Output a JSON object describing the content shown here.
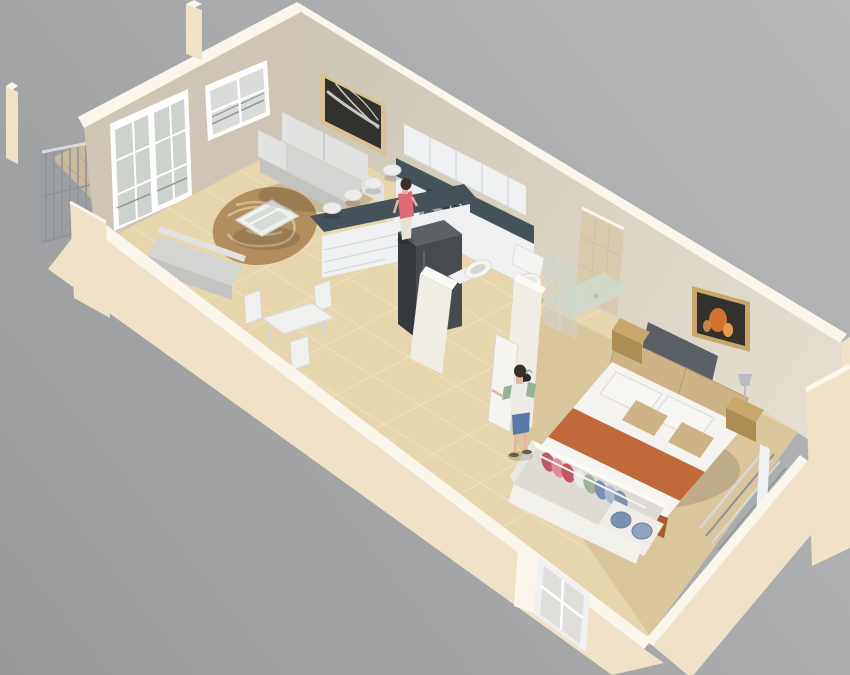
{
  "scene": {
    "type": "3d-floor-plan-render",
    "description": "Isometric 3D rendering of a studio apartment floor plan viewed from above",
    "rooms": [
      {
        "name": "balcony",
        "objects": [
          "corner-posts",
          "metal-railing",
          "plank-floor"
        ]
      },
      {
        "name": "living-room",
        "objects": [
          "sofa",
          "wall-art",
          "round-rug",
          "coffee-table",
          "bench",
          "dining-table",
          "dining-chairs",
          "bar-stools"
        ]
      },
      {
        "name": "kitchen",
        "objects": [
          "upper-cabinets",
          "dark-countertop",
          "cooktop",
          "oven",
          "refrigerator",
          "base-cabinet-drawers",
          "breakfast-bar"
        ]
      },
      {
        "name": "bathroom",
        "objects": [
          "toilet",
          "sink",
          "shower-glass-partition",
          "tiled-shower-wall",
          "floor-plant"
        ]
      },
      {
        "name": "bedroom",
        "objects": [
          "double-bed",
          "orange-runner",
          "white-pillows",
          "tan-pillows",
          "headboard",
          "nightstand-left",
          "nightstand-right",
          "table-lamp",
          "fire-wall-art",
          "open-wardrobe",
          "hanging-clothes",
          "folded-clothes",
          "window-railing",
          "corner-window"
        ]
      }
    ],
    "people": [
      {
        "name": "woman-at-kitchen-counter",
        "top_color": "#e06a78"
      },
      {
        "name": "man-near-wardrobe",
        "shorts_color": "#5b79a8"
      }
    ]
  },
  "colors": {
    "bg_top": "#b7b9bb",
    "bg_bottom": "#96989a",
    "wall_top": "#faf6ec",
    "wall_cream": "#f0e2c6",
    "wall_cream_dark": "#e2cda8",
    "wall_end_light": "#efe8d8",
    "wall_int_nw": "#cec5b4",
    "wall_int_ne_dark": "#cfc7b6",
    "wall_int_ne_light": "#e5dfd2",
    "partition_white": "#f0ede5",
    "partition_top": "#fbfaf5",
    "floor_tile": "#e6d5ad",
    "floor_grout": "#f4ead0",
    "floor_bedroom": "#dac69c",
    "carpet_edge": "#cdb88c",
    "balcony_floor": "#d8c49c",
    "plank_line": "#c5ad82",
    "rug": "#b28e5e",
    "rug_swirl": "#d9c09a",
    "glass": "#ccd6cf",
    "table_white": "#f0f1ee",
    "sofa_light": "#e2e2e0",
    "sofa_mid": "#d4d4d2",
    "sofa_dark": "#c3c3c1",
    "counter_dark": "#46525a",
    "counter_darker": "#333d44",
    "cabinet_white": "#eef0f1",
    "cabinet_line": "#d4d7d9",
    "steel": "#9aa0a4",
    "steel_dark": "#4a4e52",
    "fridge_top": "#5c6164",
    "fridge_left": "#35393c",
    "fridge_front": "#474b4e",
    "metal": "#8e9397",
    "rail_light": "#d7d9da",
    "rail_shade": "#8f9294",
    "wood": "#c8a76d",
    "wood_dark": "#ad8c55",
    "wood_floor_edge": "#d9c9a8",
    "bed_white": "#f5f3ef",
    "sheet_white": "#f7f5f1",
    "bed_orange": "#c06a3c",
    "bed_orange_dark": "#aa5a30",
    "bed_tan": "#cdb386",
    "pillow_white": "#f8f6f2",
    "pillow_line": "#e2dfd8",
    "headboard_gray": "#5b6067",
    "toilet_white": "#f4f4f2",
    "porcelain_shadow": "#d8d9d5",
    "tile_shower": "#d9ccae",
    "tile_line": "#c9bc9e",
    "clothes_red": "#c25663",
    "clothes_pink": "#de8f96",
    "clothes_blue": "#7b90b2",
    "clothes_blue2": "#8fa3bf",
    "clothes_lightblue": "#a8b8d0",
    "clothes_green": "#9db39a",
    "clothes_white": "#e9e9e7",
    "wardrobe_rim": "#fafaf7",
    "wardrobe_inner": "#dddbd4",
    "wardrobe_front": "#f2f0ea",
    "wardrobe_shelf": "#efede7",
    "skin": "#e6b69e",
    "hair": "#39302b",
    "top_pink": "#e06a78",
    "pants_light": "#e8e3da",
    "shirt_white": "#ecebe7",
    "sleeve_green": "#96b294",
    "shorts_blue": "#5b79a8",
    "sandal": "#6b5b49",
    "art_dark": "#33312d",
    "art_light": "#c9c8c4",
    "frame_tan": "#c8a76d",
    "frame_light": "#d9c294",
    "art_fire1": "#d2722e",
    "art_fire2": "#e99c4e",
    "lamp_silver": "#b9bdc1",
    "pot_dark": "#2e2a26",
    "window_glass": "#d9dcd8",
    "door_glass": "#cdd2cc",
    "shadow": "rgba(0,0,0,0.13)"
  }
}
